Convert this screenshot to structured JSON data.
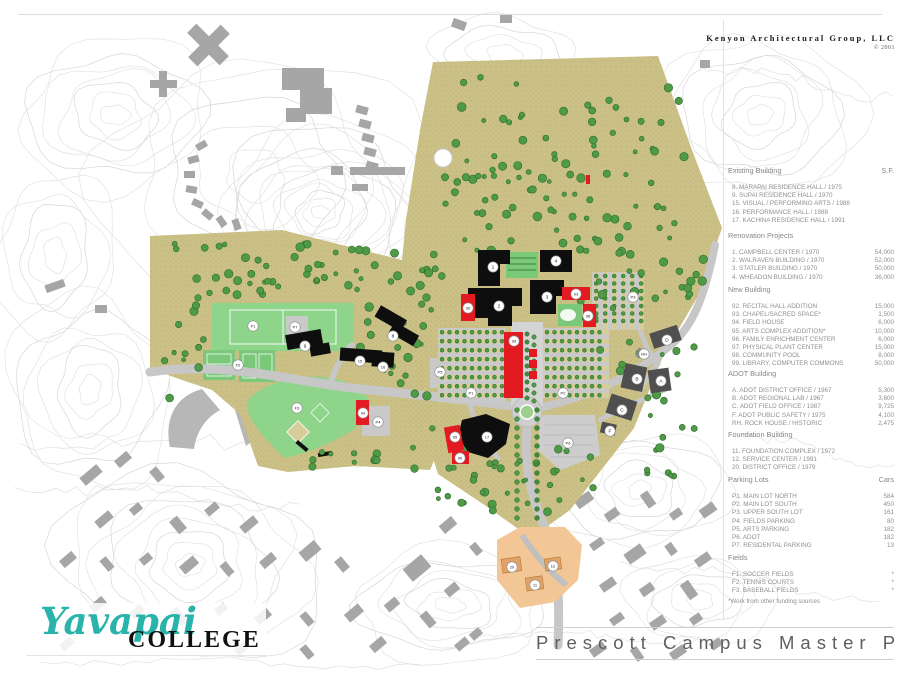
{
  "header": {
    "firm_name": "Kenyon Architectural Group, LLC",
    "copyright": "© 2001"
  },
  "logo": {
    "word1": "Yavapai",
    "word2": "COLLEGE"
  },
  "title_block": {
    "title": "Prescott Campus Master Plan"
  },
  "colors": {
    "terrain_olive": "#cbc186",
    "field_green": "#8ed58b",
    "tree_green": "#4e9a47",
    "existing_black": "#0e0e0e",
    "new_red": "#e31a22",
    "adot_gray": "#4f4f4f",
    "foundation_peach": "#f2c795",
    "city_gray": "#a6a6a6",
    "contour_gray": "#e0e0e0",
    "logo_teal": "#2ab3ab"
  },
  "legend": {
    "sections": [
      {
        "title": "Existing Building",
        "unit": "S.F.",
        "items": [
          {
            "label": "8. MARAPAI RESIDENCE HALL / 1975",
            "value": ""
          },
          {
            "label": "9. SUPAI RESIDENCE HALL / 1970",
            "value": ""
          },
          {
            "label": "15. VISUAL / PERFORMING ARTS / 1988",
            "value": ""
          },
          {
            "label": "16. PERFORMANCE HALL / 1988",
            "value": ""
          },
          {
            "label": "17. KACHINA RESIDENCE HALL / 1991",
            "value": ""
          }
        ]
      },
      {
        "title": "Renovation Projects",
        "unit": "",
        "items": [
          {
            "label": "1. CAMPBELL CENTER / 1970",
            "value": "54,000"
          },
          {
            "label": "2. WALRAVEN BUILDING / 1970",
            "value": "52,000"
          },
          {
            "label": "3. STATLER BUILDING / 1970",
            "value": "50,000"
          },
          {
            "label": "4. WHEADON BUILDING / 1970",
            "value": "36,000"
          }
        ]
      },
      {
        "title": "New Building",
        "unit": "",
        "items": [
          {
            "label": "92. RECITAL HALL ADDITION",
            "value": "15,000"
          },
          {
            "label": "93. CHAPEL/SACRED SPACE*",
            "value": "1,500"
          },
          {
            "label": "94. FIELD HOUSE",
            "value": "6,000"
          },
          {
            "label": "95. ARTS COMPLEX ADDITION*",
            "value": "10,000"
          },
          {
            "label": "96. FAMILY ENRICHMENT CENTER",
            "value": "6,000"
          },
          {
            "label": "97. PHYSICAL PLANT CENTER",
            "value": "15,000"
          },
          {
            "label": "98. COMMUNITY POOL",
            "value": "8,000"
          },
          {
            "label": "99. LIBRARY, COMPUTER COMMONS",
            "value": "50,000"
          }
        ]
      },
      {
        "title": "ADOT Building",
        "unit": "",
        "items": [
          {
            "label": "A. ADOT DISTRICT OFFICE / 1967",
            "value": "5,300"
          },
          {
            "label": "B. ADOT REGIONAL LAB / 1967",
            "value": "3,600"
          },
          {
            "label": "C. ADOT FIELD OFFICE / 1987",
            "value": "9,725"
          },
          {
            "label": "F. ADOT PUBLIC SAFETY / 1975",
            "value": "4,100"
          },
          {
            "label": "RH. ROCK HOUSE / HISTORIC",
            "value": "2,475"
          }
        ]
      },
      {
        "title": "Foundation Building",
        "unit": "",
        "items": [
          {
            "label": "11. FOUNDATION COMPLEX / 1972",
            "value": ""
          },
          {
            "label": "12. SERVICE CENTER / 1991",
            "value": ""
          },
          {
            "label": "20. DISTRICT OFFICE / 1979",
            "value": ""
          }
        ]
      },
      {
        "title": "Parking Lots",
        "unit": "Cars",
        "items": [
          {
            "label": "P1. MAIN LOT NORTH",
            "value": "584"
          },
          {
            "label": "P2. MAIN LOT SOUTH",
            "value": "450"
          },
          {
            "label": "P3. UPPER SOUTH LOT",
            "value": "161"
          },
          {
            "label": "P4. FIELDS PARKING",
            "value": "80"
          },
          {
            "label": "P5. ARTS PARKING",
            "value": "182"
          },
          {
            "label": "P6. ADOT",
            "value": "182"
          },
          {
            "label": "P7. RESIDENTAL PARKING",
            "value": "13"
          }
        ]
      },
      {
        "title": "Fields",
        "unit": "",
        "items": [
          {
            "label": "F1. SOCCER FIELDS",
            "value": "*"
          },
          {
            "label": "F2. TENNIS COURTS",
            "value": "*"
          },
          {
            "label": "F3. BASEBALL FIELDS",
            "value": "*"
          }
        ]
      }
    ],
    "footnote": "*Work from other funding sources"
  },
  "map": {
    "labels": [
      {
        "text": "1",
        "x": 493,
        "y": 267
      },
      {
        "text": "4",
        "x": 556,
        "y": 261
      },
      {
        "text": "2",
        "x": 499,
        "y": 306
      },
      {
        "text": "3",
        "x": 547,
        "y": 297
      },
      {
        "text": "8",
        "x": 393,
        "y": 336
      },
      {
        "text": "9",
        "x": 305,
        "y": 346
      },
      {
        "text": "15",
        "x": 360,
        "y": 361
      },
      {
        "text": "16",
        "x": 383,
        "y": 367
      },
      {
        "text": "17",
        "x": 487,
        "y": 437
      },
      {
        "text": "92",
        "x": 468,
        "y": 308
      },
      {
        "text": "93",
        "x": 576,
        "y": 294
      },
      {
        "text": "94",
        "x": 363,
        "y": 413
      },
      {
        "text": "95",
        "x": 455,
        "y": 437
      },
      {
        "text": "96",
        "x": 460,
        "y": 458
      },
      {
        "text": "98",
        "x": 588,
        "y": 316
      },
      {
        "text": "99",
        "x": 514,
        "y": 341
      },
      {
        "text": "11",
        "x": 535,
        "y": 585
      },
      {
        "text": "12",
        "x": 553,
        "y": 566
      },
      {
        "text": "20",
        "x": 512,
        "y": 567
      },
      {
        "text": "A",
        "x": 661,
        "y": 381
      },
      {
        "text": "B",
        "x": 637,
        "y": 379
      },
      {
        "text": "C",
        "x": 622,
        "y": 410
      },
      {
        "text": "D",
        "x": 667,
        "y": 340
      },
      {
        "text": "F",
        "x": 610,
        "y": 431
      },
      {
        "text": "RH",
        "x": 644,
        "y": 354
      },
      {
        "text": "P1",
        "x": 471,
        "y": 393
      },
      {
        "text": "P2",
        "x": 563,
        "y": 393
      },
      {
        "text": "P3",
        "x": 633,
        "y": 297
      },
      {
        "text": "P4",
        "x": 378,
        "y": 422
      },
      {
        "text": "P5",
        "x": 440,
        "y": 372
      },
      {
        "text": "P6",
        "x": 568,
        "y": 443
      },
      {
        "text": "P7",
        "x": 295,
        "y": 327
      },
      {
        "text": "F1",
        "x": 253,
        "y": 326
      },
      {
        "text": "F2",
        "x": 238,
        "y": 365
      },
      {
        "text": "F3",
        "x": 297,
        "y": 408
      }
    ]
  }
}
